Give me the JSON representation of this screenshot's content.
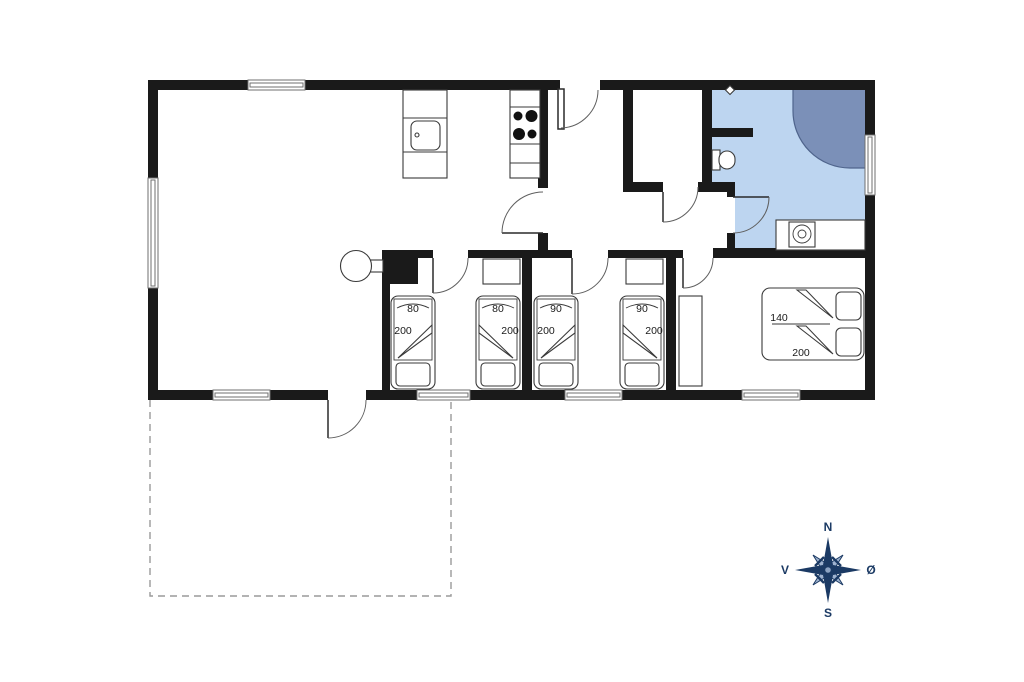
{
  "plan": {
    "kind": "holiday-house floor plan",
    "background": "#ffffff"
  },
  "beds": {
    "singles": [
      {
        "width_label": "80",
        "length_label": "200"
      },
      {
        "width_label": "80",
        "length_label": "200"
      },
      {
        "width_label": "90",
        "length_label": "200"
      },
      {
        "width_label": "90",
        "length_label": "200"
      }
    ],
    "double": {
      "width_label": "140",
      "length_label": "200"
    }
  },
  "compass": {
    "north_label": "N",
    "east_label": "Ø",
    "south_label": "S",
    "west_label": "V"
  },
  "colors": {
    "wall": "#1a1a1a",
    "floor": "#ffffff",
    "bathroom_floor": "#bdd5f0",
    "shower": "#7b90b8",
    "shower_outline": "#4f648c",
    "door_arc": "#5f5f5f",
    "window_line": "#6f6f6f",
    "terrace_dash": "#9a9a9a",
    "label_text": "#1a1a1a",
    "compass_dark": "#1b3a64",
    "compass_pale": "#9fb3cf",
    "compass_center_dot": "#8ba2c2"
  }
}
